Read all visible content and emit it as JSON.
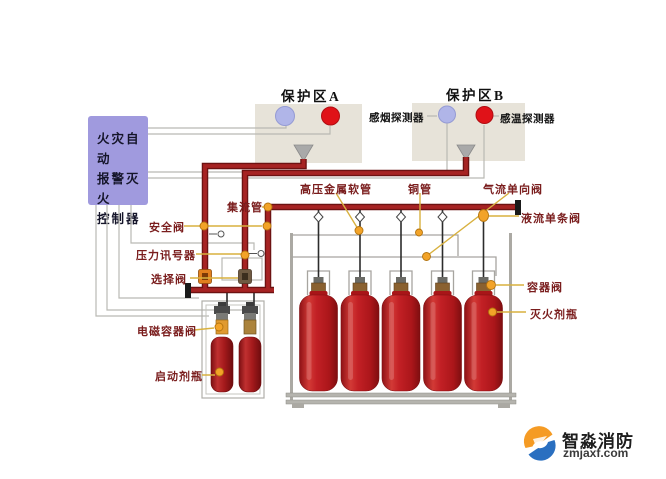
{
  "controller": {
    "line1": "火灾自动",
    "line2": "报警灭火",
    "line3": "控制器"
  },
  "zone_a": {
    "title": "保护区A"
  },
  "zone_b": {
    "title": "保护区B"
  },
  "detectors": {
    "smoke_label": "感烟探测器",
    "heat_label": "感温探测器"
  },
  "labels": {
    "manifold": "集流管",
    "high_pressure_hose": "高压金属软管",
    "copper_pipe": "铜管",
    "gas_check_valve": "气流单向阀",
    "liquid_check_valve": "液流单条阀",
    "safety_valve": "安全阀",
    "pressure_signal": "压力讯号器",
    "selector_valve": "选择阀",
    "solenoid_container_valve": "电磁容器阀",
    "starter_bottle": "启动剂瓶",
    "container_valve": "容器阀",
    "agent_bottle": "灭火剂瓶"
  },
  "equipment": {
    "agent_cylinder_count": 5,
    "starter_bottle_count": 2
  },
  "branding": {
    "name": "智淼消防",
    "domain": "zmjaxf.com"
  },
  "colors": {
    "pipe_red": "#9c1b1b",
    "label_red": "#7a1d1d",
    "controller_purple": "#a09ade",
    "zone_box": "#e7e3d9",
    "leader_gold": "#d8b13f",
    "marker_orange": "#f2a328",
    "cylinder_red": "#c01a1f",
    "brand_orange": "#f59b24",
    "brand_blue": "#2a6fc0"
  }
}
